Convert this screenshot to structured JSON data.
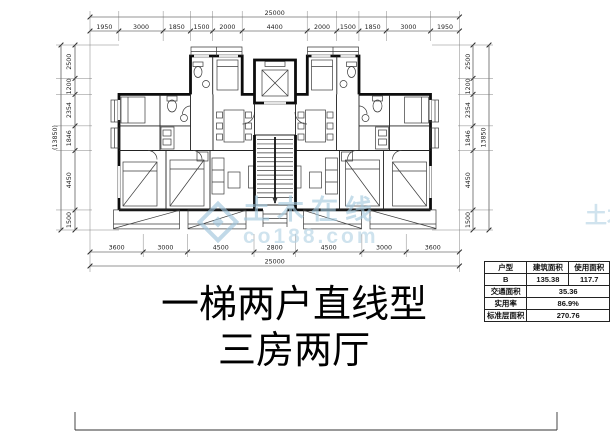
{
  "title": {
    "line1": "一梯两户直线型",
    "line2": "三房两厅"
  },
  "watermark": {
    "site_name": "土木在线",
    "site_url": "co188.com",
    "color": "#a3c9de"
  },
  "dimensions": {
    "top_total": "25000",
    "top_segments": [
      "1950",
      "3000",
      "1850",
      "1500",
      "2000",
      "4400",
      "2000",
      "1500",
      "1850",
      "3000",
      "1950"
    ],
    "bottom_segments": [
      "3600",
      "3000",
      "4500",
      "2800",
      "4500",
      "3000",
      "3600"
    ],
    "bottom_total": "25000",
    "left_segments": [
      "2500",
      "1200",
      "2354",
      "1846",
      "4450",
      "1500"
    ],
    "left_total": "(13850)",
    "right_segments": [
      "2500",
      "1200",
      "2354",
      "1846",
      "4450",
      "1500"
    ],
    "right_total": "13850"
  },
  "table": {
    "headers": [
      "户型",
      "建筑面积",
      "使用面积"
    ],
    "unit_row": {
      "type": "B",
      "build_area": "135.38",
      "use_area": "117.7"
    },
    "rows": [
      {
        "label": "交通面积",
        "value": "35.36"
      },
      {
        "label": "实用率",
        "value": "86.9%"
      },
      {
        "label": "标准层面积",
        "value": "270.76"
      }
    ]
  },
  "colors": {
    "line": "#0d0d0d",
    "paper": "#ffffff",
    "watermark_blue": "#a3c9de"
  }
}
